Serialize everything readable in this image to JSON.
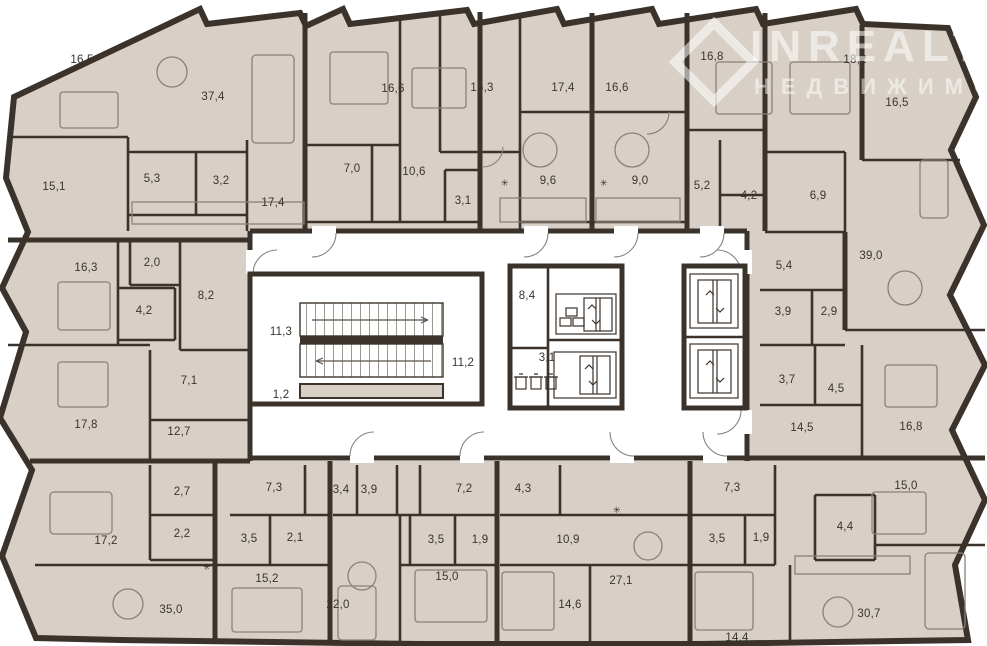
{
  "plan": {
    "type": "residential-floor-plan",
    "units_note": "multi-apartment floor with central stair and elevator core",
    "colors": {
      "floor_fill": "#d8d0c6",
      "wall": "#3b332b",
      "common_area": "#ffffff",
      "furniture_stroke": "#8a8177",
      "label_text": "#3a342e"
    },
    "core": {
      "stair_flights": 2,
      "elevator_count": 4,
      "trash_bin_count": 3
    }
  },
  "watermark": {
    "icon": "diamond-outline-icon",
    "line1": "INREALT",
    "line2": "НЕДВИЖИМОСТЬ"
  },
  "rooms": [
    {
      "area": "16,5",
      "x": 82,
      "y": 60
    },
    {
      "area": "37,4",
      "x": 213,
      "y": 97
    },
    {
      "area": "16,6",
      "x": 393,
      "y": 89
    },
    {
      "area": "15,3",
      "x": 482,
      "y": 88
    },
    {
      "area": "17,4",
      "x": 563,
      "y": 88
    },
    {
      "area": "16,6",
      "x": 617,
      "y": 88
    },
    {
      "area": "16,8",
      "x": 712,
      "y": 57
    },
    {
      "area": "18,2",
      "x": 855,
      "y": 60
    },
    {
      "area": "16,5",
      "x": 897,
      "y": 103
    },
    {
      "area": "15,1",
      "x": 54,
      "y": 187
    },
    {
      "area": "5,3",
      "x": 152,
      "y": 179
    },
    {
      "area": "3,2",
      "x": 221,
      "y": 181
    },
    {
      "area": "17,4",
      "x": 273,
      "y": 203
    },
    {
      "area": "7,0",
      "x": 352,
      "y": 169
    },
    {
      "area": "10,6",
      "x": 414,
      "y": 172
    },
    {
      "area": "3,1",
      "x": 463,
      "y": 201
    },
    {
      "area": "9,6",
      "x": 548,
      "y": 181
    },
    {
      "area": "9,0",
      "x": 640,
      "y": 181
    },
    {
      "area": "5,2",
      "x": 702,
      "y": 186
    },
    {
      "area": "4,2",
      "x": 749,
      "y": 196
    },
    {
      "area": "6,9",
      "x": 818,
      "y": 196
    },
    {
      "area": "39,0",
      "x": 871,
      "y": 256
    },
    {
      "area": "16,3",
      "x": 86,
      "y": 268
    },
    {
      "area": "2,0",
      "x": 152,
      "y": 263
    },
    {
      "area": "4,2",
      "x": 144,
      "y": 311
    },
    {
      "area": "8,2",
      "x": 206,
      "y": 296
    },
    {
      "area": "7,1",
      "x": 189,
      "y": 381
    },
    {
      "area": "17,8",
      "x": 86,
      "y": 425
    },
    {
      "area": "12,7",
      "x": 179,
      "y": 432
    },
    {
      "area": "11,3",
      "x": 281,
      "y": 332
    },
    {
      "area": "1,2",
      "x": 281,
      "y": 395
    },
    {
      "area": "11,2",
      "x": 463,
      "y": 363
    },
    {
      "area": "8,4",
      "x": 527,
      "y": 296
    },
    {
      "area": "3,1",
      "x": 547,
      "y": 358
    },
    {
      "area": "5,4",
      "x": 784,
      "y": 266
    },
    {
      "area": "3,9",
      "x": 783,
      "y": 312
    },
    {
      "area": "2,9",
      "x": 829,
      "y": 312
    },
    {
      "area": "3,7",
      "x": 787,
      "y": 380
    },
    {
      "area": "4,5",
      "x": 836,
      "y": 389
    },
    {
      "area": "14,5",
      "x": 802,
      "y": 428
    },
    {
      "area": "16,8",
      "x": 911,
      "y": 427
    },
    {
      "area": "2,7",
      "x": 182,
      "y": 492
    },
    {
      "area": "2,2",
      "x": 182,
      "y": 534
    },
    {
      "area": "17,2",
      "x": 106,
      "y": 541
    },
    {
      "area": "35,0",
      "x": 171,
      "y": 610
    },
    {
      "area": "7,3",
      "x": 274,
      "y": 488
    },
    {
      "area": "3,5",
      "x": 249,
      "y": 539
    },
    {
      "area": "2,1",
      "x": 295,
      "y": 538
    },
    {
      "area": "15,2",
      "x": 267,
      "y": 579
    },
    {
      "area": "3,4",
      "x": 341,
      "y": 490
    },
    {
      "area": "3,9",
      "x": 369,
      "y": 490
    },
    {
      "area": "7,2",
      "x": 464,
      "y": 489
    },
    {
      "area": "4,3",
      "x": 523,
      "y": 489
    },
    {
      "area": "3,5",
      "x": 436,
      "y": 540
    },
    {
      "area": "1,9",
      "x": 480,
      "y": 540
    },
    {
      "area": "10,9",
      "x": 568,
      "y": 540
    },
    {
      "area": "15,0",
      "x": 447,
      "y": 577
    },
    {
      "area": "22,0",
      "x": 338,
      "y": 605
    },
    {
      "area": "14,6",
      "x": 570,
      "y": 605
    },
    {
      "area": "27,1",
      "x": 621,
      "y": 581
    },
    {
      "area": "7,3",
      "x": 732,
      "y": 488
    },
    {
      "area": "3,5",
      "x": 717,
      "y": 539
    },
    {
      "area": "1,9",
      "x": 761,
      "y": 538
    },
    {
      "area": "4,4",
      "x": 845,
      "y": 527
    },
    {
      "area": "15,0",
      "x": 906,
      "y": 486
    },
    {
      "area": "30,7",
      "x": 869,
      "y": 614
    },
    {
      "area": "14,4",
      "x": 737,
      "y": 638
    }
  ]
}
